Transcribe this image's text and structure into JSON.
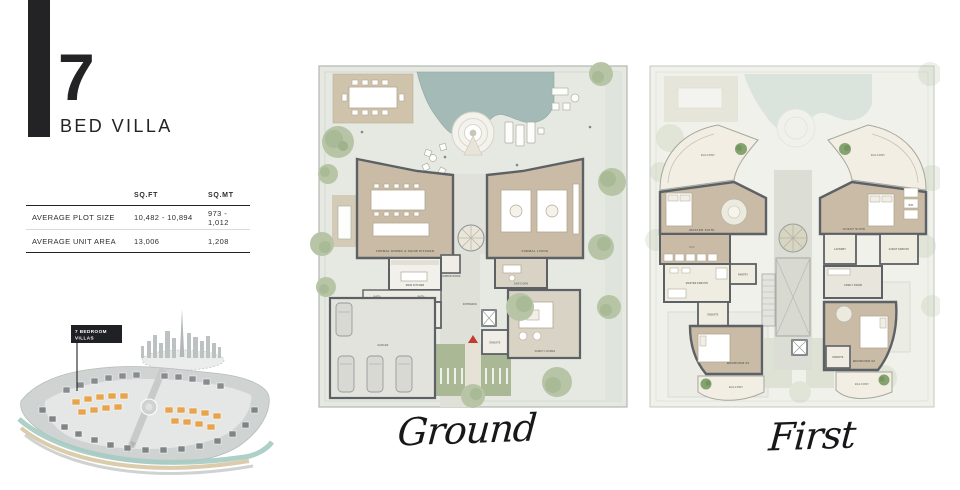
{
  "header": {
    "number": "7",
    "subtitle": "BED VILLA"
  },
  "table": {
    "headers": [
      "SQ.FT",
      "SQ.MT"
    ],
    "rows": [
      {
        "label": "AVERAGE PLOT SIZE",
        "sqft": "10,482 - 10,894",
        "sqmt": "973 - 1,012"
      },
      {
        "label": "AVERAGE UNIT AREA",
        "sqft": "13,006",
        "sqmt": "1,208"
      }
    ]
  },
  "sitemap": {
    "callout_line1": "7 BEDROOM",
    "callout_line2": "VILLAS",
    "highlight_color": "#e8a44c"
  },
  "plans": {
    "ground": {
      "caption": "Ground",
      "labels": {
        "formal_dining": "FORMAL DINING & SHOW KITCHEN",
        "main_kitchen": "MAIN KITCHEN",
        "formal_living": "FORMAL LIVING",
        "dads_den": "DAD'S DEN",
        "powder_room": "POWDER ROOM",
        "family_lounge": "FAMILY LOUNGE",
        "ensuite": "ENSUITE",
        "entrance": "ENTRANCE",
        "garage": "GARAGE",
        "maids_room": "MAID'S RM",
        "drivers_room": "DRIVER'S RM",
        "bath1": "BATH",
        "bath2": "BATH"
      }
    },
    "first": {
      "caption": "First",
      "labels": {
        "balcony_tl": "BALCONY",
        "balcony_tr": "BALCONY",
        "balcony_bl": "BALCONY",
        "balcony_br": "BALCONY",
        "master_suite": "MASTER SUITE",
        "wic_left": "WIC",
        "wic_right": "WIC",
        "master_ensuite": "MASTER ENSUITE",
        "pantry": "PANTRY",
        "ensuite_03": "ENSUITE",
        "ensuite_02": "ENSUITE",
        "bedroom_03": "BEDROOM 03",
        "bedroom_02": "BEDROOM 02",
        "guest_suite": "GUEST SUITE",
        "guest_ensuite": "GUEST ENSUITE",
        "laundry": "LAUNDRY",
        "family_room": "FAMILY ROOM"
      }
    }
  },
  "colors": {
    "ink": "#232325",
    "wall": "#5d6165",
    "floor_tan": "#c9bba6",
    "pool": "#a3bab7",
    "tree": "#b7c4a6",
    "highlight_orange": "#e8a44c"
  }
}
